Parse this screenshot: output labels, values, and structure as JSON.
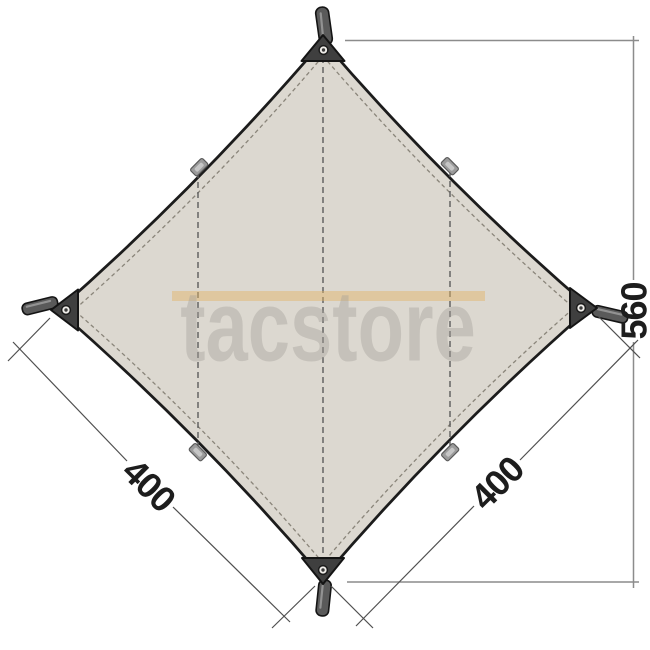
{
  "watermark": {
    "text": "tacstore"
  },
  "dimensions": {
    "vertical_span": "560",
    "lower_left_edge": "400",
    "lower_right_edge": "400"
  },
  "colors": {
    "background": "#ffffff",
    "canvas_fill": "#dcd8d0",
    "outline": "#1c1c1c",
    "stitching": "#8a857a",
    "seam": "#5c5c5c",
    "corner_patch": "#3f3f3f",
    "webbing_tab": "#9b9b9b",
    "webbing_tab_highlight": "#c6c6c6",
    "strap": "#5a5a5a",
    "strap_highlight": "#929292",
    "grommet_ring": "#efede9",
    "grommet_hole": "#3c3c3c",
    "dimension_line": "#8c8c8c",
    "edge_dimension_line": "#4f4f4f",
    "dimension_text": "#1d1d1d",
    "watermark_text": "#a5a19a",
    "watermark_band": "#e2b463"
  }
}
